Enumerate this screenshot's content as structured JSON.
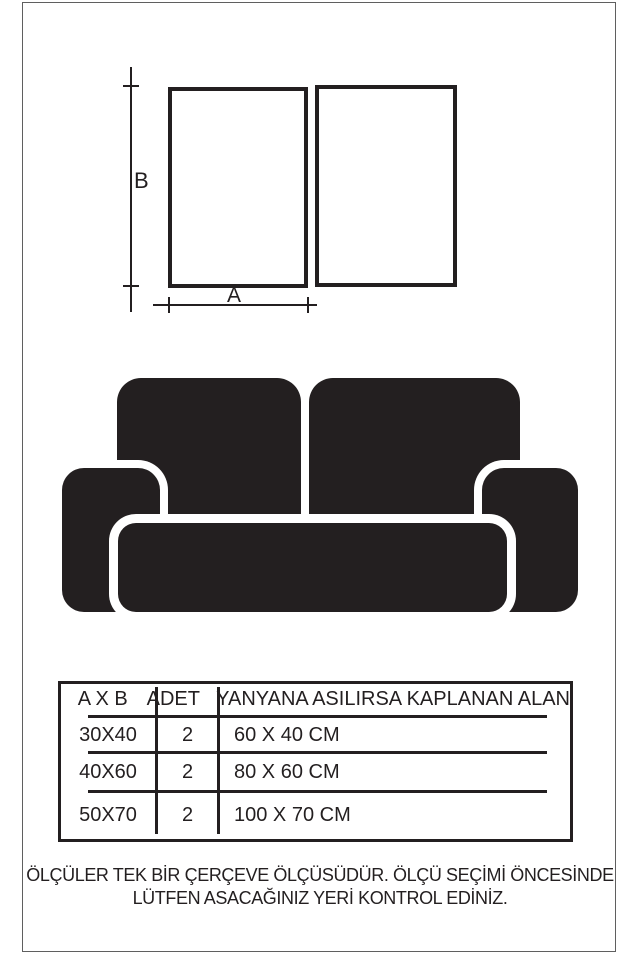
{
  "colors": {
    "ink": "#231f20",
    "background": "#ffffff",
    "page_frame_border": "#5f5f5f"
  },
  "illustrations": {
    "frames": "two-empty-frame-outlines",
    "sofa": "sofa-silhouette"
  },
  "diagram": {
    "height_label": "B",
    "width_label": "A"
  },
  "table": {
    "headers": [
      "A X B",
      "ADET",
      "YANYANA ASILIRSA KAPLANAN ALAN"
    ],
    "rows": [
      [
        "30X40",
        "2",
        "60 X 40 CM"
      ],
      [
        "40X60",
        "2",
        "80 X 60 CM"
      ],
      [
        "50X70",
        "2",
        "100 X 70 CM"
      ]
    ]
  },
  "footer": {
    "line1": "ÖLÇÜLER TEK BİR ÇERÇEVE ÖLÇÜSÜDÜR. ÖLÇÜ SEÇİMİ ÖNCESİNDE",
    "line2": "LÜTFEN ASACAĞINIZ YERİ KONTROL EDİNİZ."
  }
}
